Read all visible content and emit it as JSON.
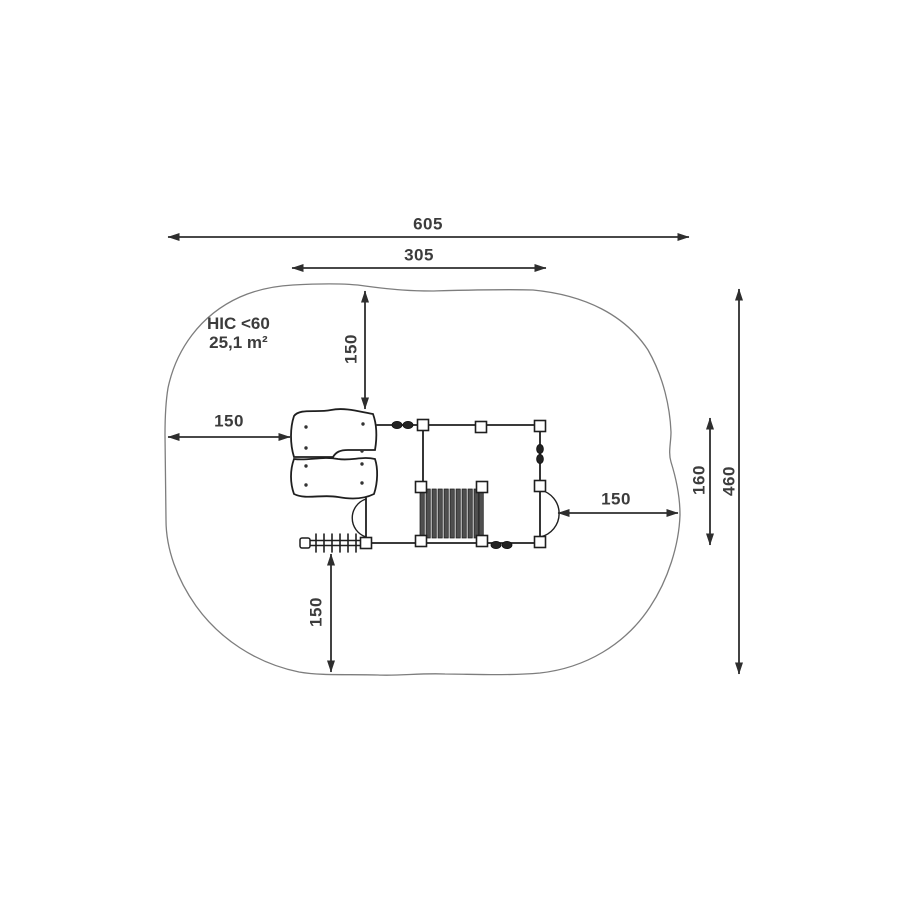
{
  "diagram": {
    "title": "playground-equipment-safety-zone-plan",
    "annotations": {
      "hic": "HIC <60",
      "area": "25,1 m²"
    },
    "dimensions": {
      "overall_width": "605",
      "inner_width": "305",
      "top_clearance": "150",
      "left_clearance": "150",
      "right_clearance": "150",
      "bottom_clearance": "150",
      "side_height": "160",
      "overall_height": "460"
    },
    "colors": {
      "dimension_line": "#2e2e2e",
      "zone_outline": "#7d7d7d",
      "structure_line": "#1f1f1f",
      "slat_fill": "#4f4f4f",
      "label_text": "#3c3c3c",
      "background": "#ffffff"
    }
  }
}
